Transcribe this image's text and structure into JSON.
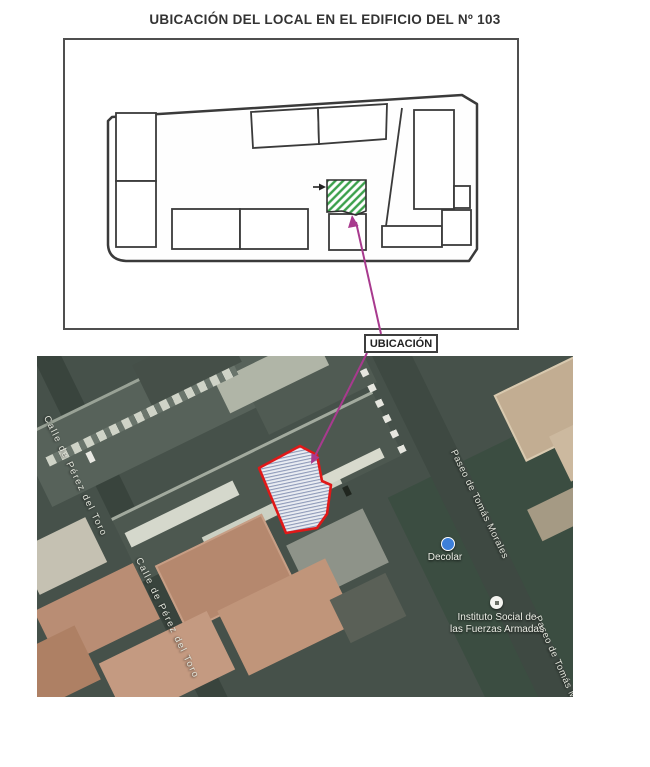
{
  "title": "UBICACIÓN DEL LOCAL EN EL EDIFICIO DEL Nº 103",
  "plan": {
    "street_top": "C/ PEREZ DEL TORO",
    "street_bottom": "C/ PASEO TOMAS MORALES",
    "street_right": "AVDA. JUAN XXIII",
    "location_label": "UBICACIÓN",
    "highlight_hatch_color": "#3ba04b",
    "arrow_color": "#a83a8e"
  },
  "map": {
    "street_calle": "Calle de Pérez del Toro",
    "street_paseo": "Paseo de Tomás Morales",
    "poi_decolar": "Decolar",
    "poi_instituto_line1": "Instituto Social de",
    "poi_instituto_line2": "las Fuerzas Armadas",
    "parcel_outline_color": "#e01818"
  }
}
